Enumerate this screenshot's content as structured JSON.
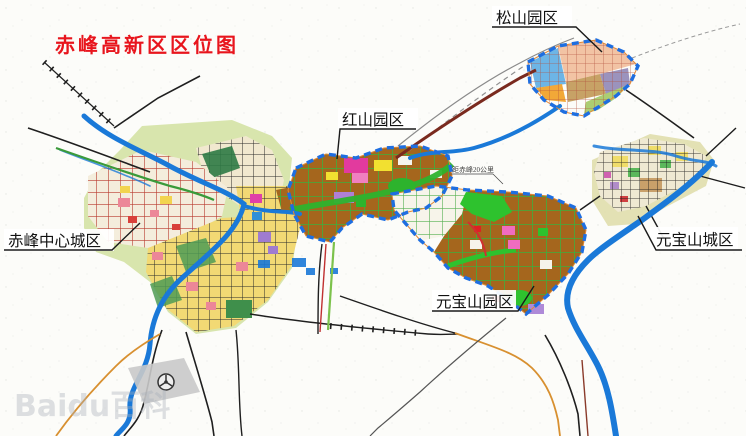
{
  "title": {
    "text": "赤峰高新区区位图"
  },
  "map_labels": {
    "songshan_park": "松山园区",
    "hongshan_park": "红山园区",
    "chifeng_central_city": "赤峰中心城区",
    "yuanbaoshan_park": "元宝山园区",
    "yuanbaoshan_city": "元宝山城区",
    "distance_note": "距赤峰20公里"
  },
  "watermark": "Baidu百科",
  "colors": {
    "title_red": "#e8151d",
    "river_blue": "#1a79d8",
    "boundary_blue": "#1e6ee0",
    "boundary_underlay_orange": "#e08838",
    "district_brown": "#a5661d",
    "district_yellow": "#f2d974",
    "green_road": "#3fae3d",
    "city_backdrop_green": "#d8e5ad",
    "songshan_blue": "#6db5e6",
    "songshan_salmon": "#f2c3a4",
    "songshan_orange": "#f2a838",
    "songshan_tan": "#c7a266",
    "songshan_purple": "#9b93bd",
    "songshan_green": "#accd72"
  }
}
